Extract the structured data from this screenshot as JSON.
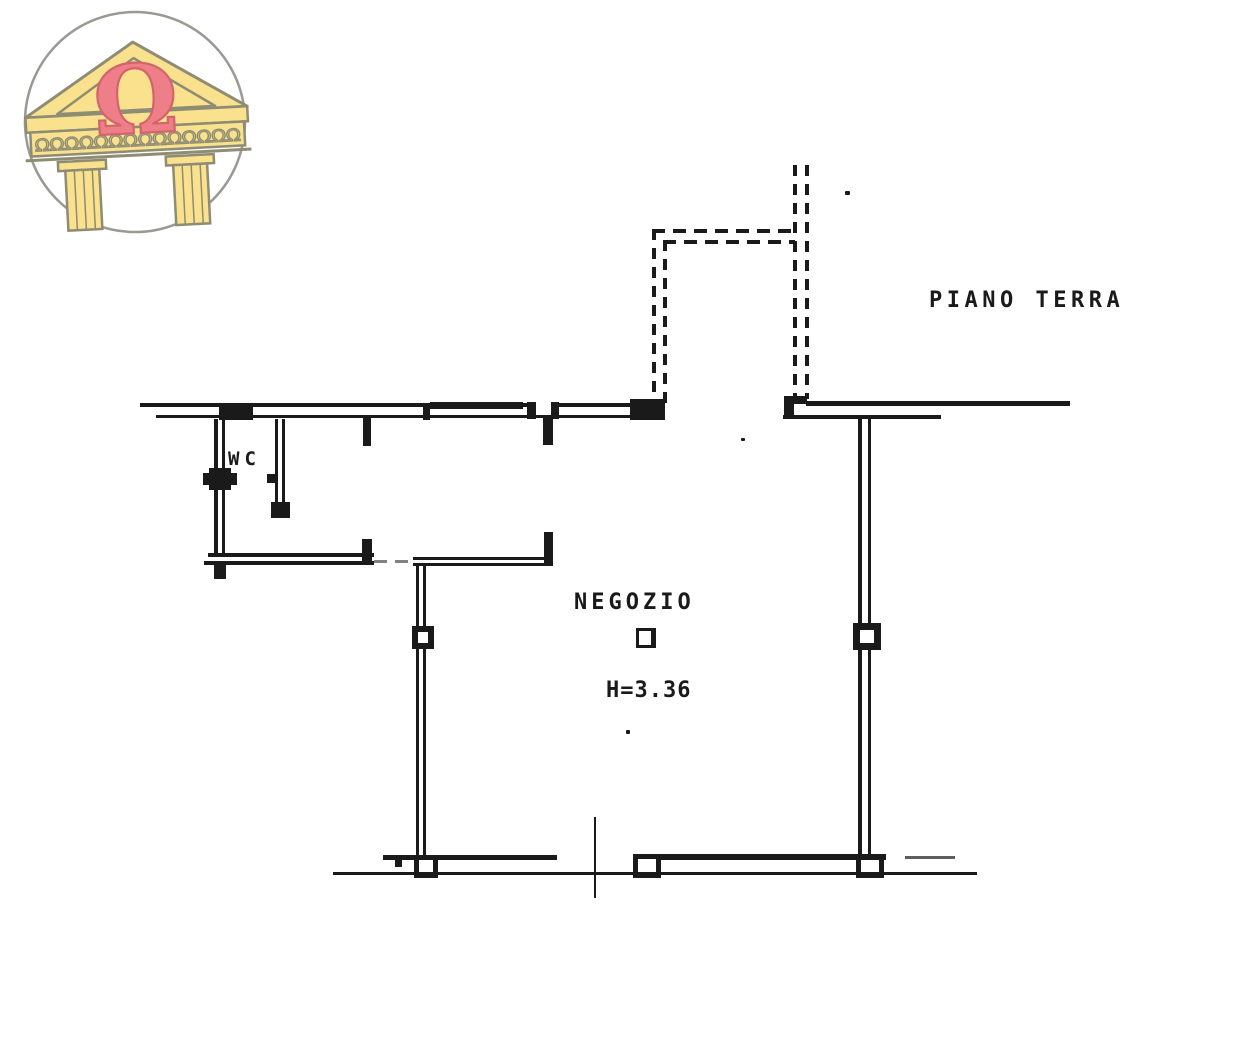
{
  "colors": {
    "ink": "#1a1a1a",
    "paper": "#ffffff",
    "logo_yellow": "#f9e18d",
    "logo_outline": "#8f8c74",
    "logo_omega_pink": "#ee7e87",
    "logo_omega_outline": "#d2646e",
    "logo_circle_gray": "#9a9a93"
  },
  "logo": {
    "omega": "Ω",
    "frieze_text": "ΩΩΩΩΩΩΩΩΩΩΩΩΩΩ"
  },
  "plan": {
    "labels": {
      "floor": "PIANO TERRA",
      "wc": "WC",
      "room": "NEGOZIO",
      "height": "H=3.36"
    }
  }
}
